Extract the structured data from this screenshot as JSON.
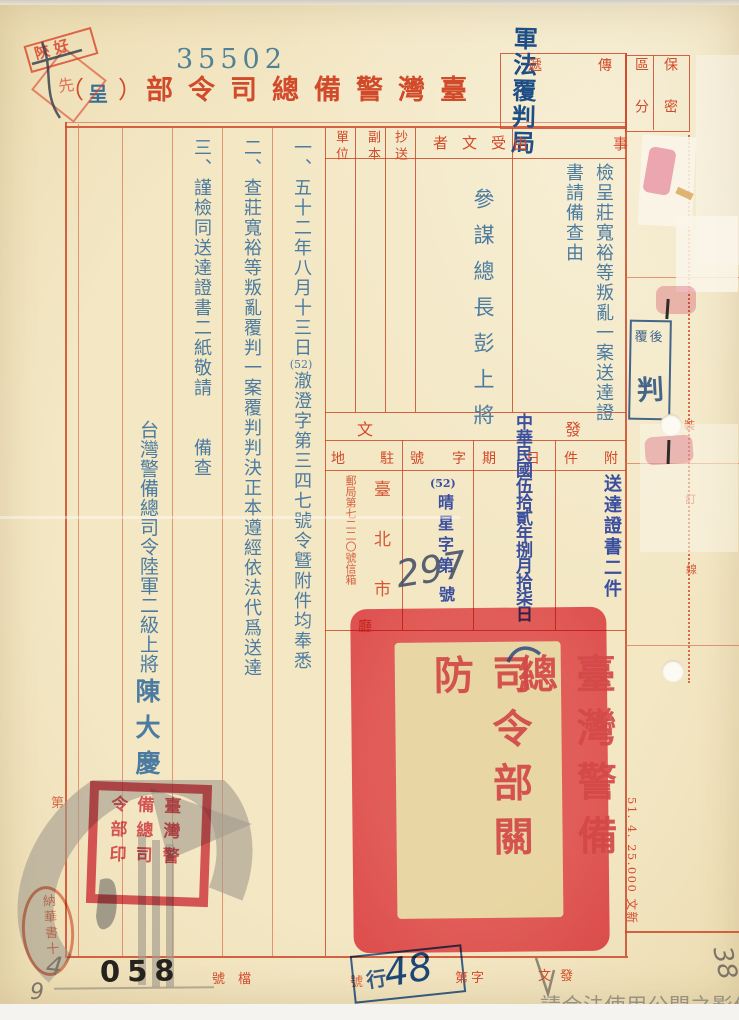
{
  "page": {
    "serial": "35502",
    "org_title": "臺灣警備總司令部",
    "note_open": "（",
    "note_char": "呈",
    "note_close": "）"
  },
  "corner_stamp": {
    "text": "陝好",
    "diamond_char": "先"
  },
  "top_right": {
    "handwritten_office": "軍法覆判局",
    "transmit_label": "傳遞",
    "security_right": "保密",
    "security_left": "區分"
  },
  "headers": {
    "subject": "事由",
    "recipient": "受文者",
    "copy_to": "抄送",
    "duplicate": "副本",
    "unit": "單位"
  },
  "subject": {
    "line1": "檢呈莊寬裕等叛亂一案送達證",
    "line2": "書請備查由"
  },
  "recipient_value": "參謀總長彭上將",
  "body": {
    "col1_pre": "一、五十二年八月十三日",
    "col1_num": "(52)",
    "col1_post": "澈澄字第三四七號令曁附件均奉悉",
    "col2": "二、查莊寬裕等叛亂覆判一案覆判判決正本遵經依法代爲送達",
    "col3": "三、謹檢同送達證書二紙敬請　　備查",
    "signer_title": "台灣警備總司令陸軍二級上將",
    "signer_name": "陳大慶"
  },
  "issue": {
    "header": "發文",
    "attachment_label": "附件",
    "attachment_value": "送達證書二件",
    "date_label": "日期",
    "date_value": "中華民國伍拾貳年捌月拾柒日",
    "number_label": "字號",
    "number_year": "(52)",
    "number_prefix": "晴星字第",
    "number_handwritten": "297",
    "number_suffix": "號",
    "station_label": "駐地",
    "station_value": "臺北市",
    "station_address": "郵局第七二二〇號信箱",
    "station_extra": "廳"
  },
  "review_stamp": {
    "top": "覆後",
    "main": "判"
  },
  "binding_line": {
    "chars": [
      "裝",
      "訂",
      "線"
    ]
  },
  "print_note": "51. 4. 25.000 文新",
  "seals": {
    "large_right_col": "臺灣警備總",
    "large_left_col": "司令部關防",
    "small_seal_col1": "臺灣警",
    "small_seal_col2": "備總司",
    "small_seal_col3": "令部印",
    "oval_seal": "納華書十"
  },
  "bottom": {
    "file_label": "檔號",
    "file_number": "058",
    "issue_label": "發文",
    "number_label": "字第",
    "number_suffix": "號",
    "stamp_char": "行",
    "handwritten_no": "48",
    "pencil_a": "4",
    "pencil_b": "9",
    "pencil_corner": "38",
    "margin_char": "第"
  },
  "watermark_text": "請合法使用公開之影像",
  "colors": {
    "form_red": "#cd4a2c",
    "title_red": "#d14a2a",
    "body_blue": "#4b7ba0",
    "carbon_indigo": "#3b4fa0",
    "seal_red": "#ea5062",
    "stamp_blue": "#2d5a9e"
  }
}
